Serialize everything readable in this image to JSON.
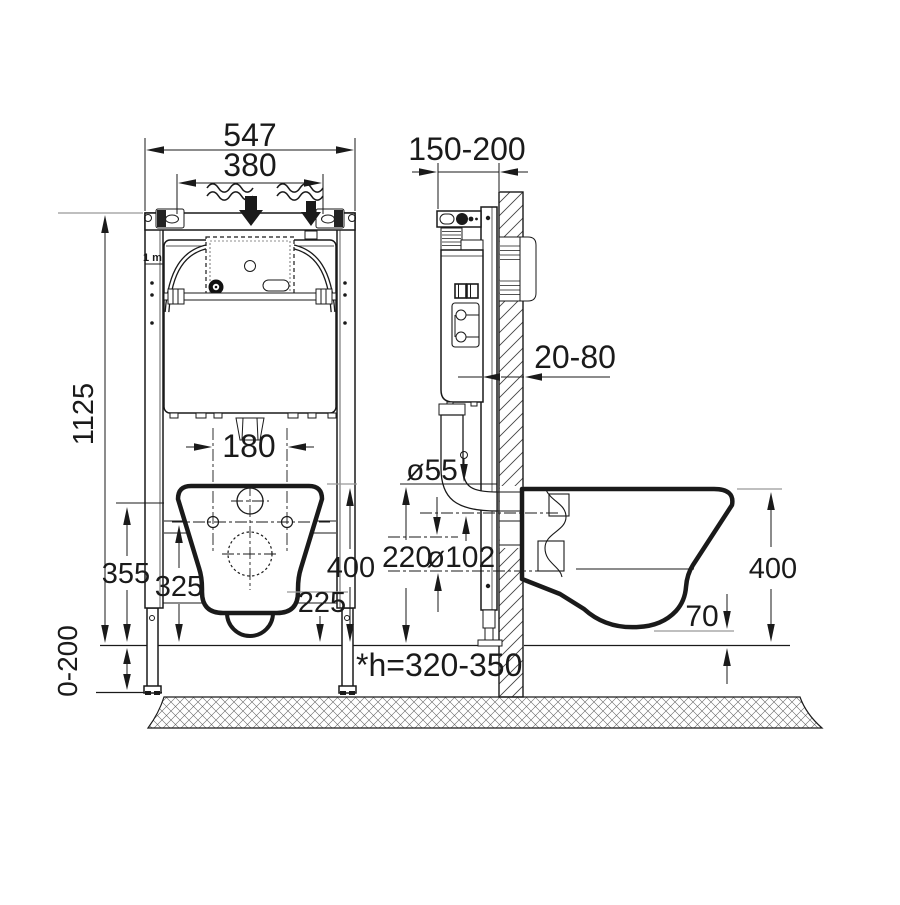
{
  "drawing": {
    "type": "wall-hung-toilet-frame-installation-diagram",
    "front_view": {
      "total_width": "547",
      "inner_width": "380",
      "frame_height": "1125",
      "meter_mark": "1 m",
      "bolt_spacing": "180",
      "dim_355": "355",
      "dim_325": "325",
      "dim_225": "225",
      "bowl_top_height": "400",
      "floor_adjustment": "0-200"
    },
    "side_view": {
      "frame_depth": "150-200",
      "wall_clearance": "20-80",
      "flush_pipe_dia": "ø55",
      "pipe_offset": "220",
      "outlet_dia": "ø102",
      "bowl_height": "400",
      "bottom_clearance": "70",
      "outlet_note": "*h=320-350"
    },
    "colors": {
      "ink": "#1a1a1a",
      "reference": "#999999",
      "background": "#ffffff"
    }
  }
}
